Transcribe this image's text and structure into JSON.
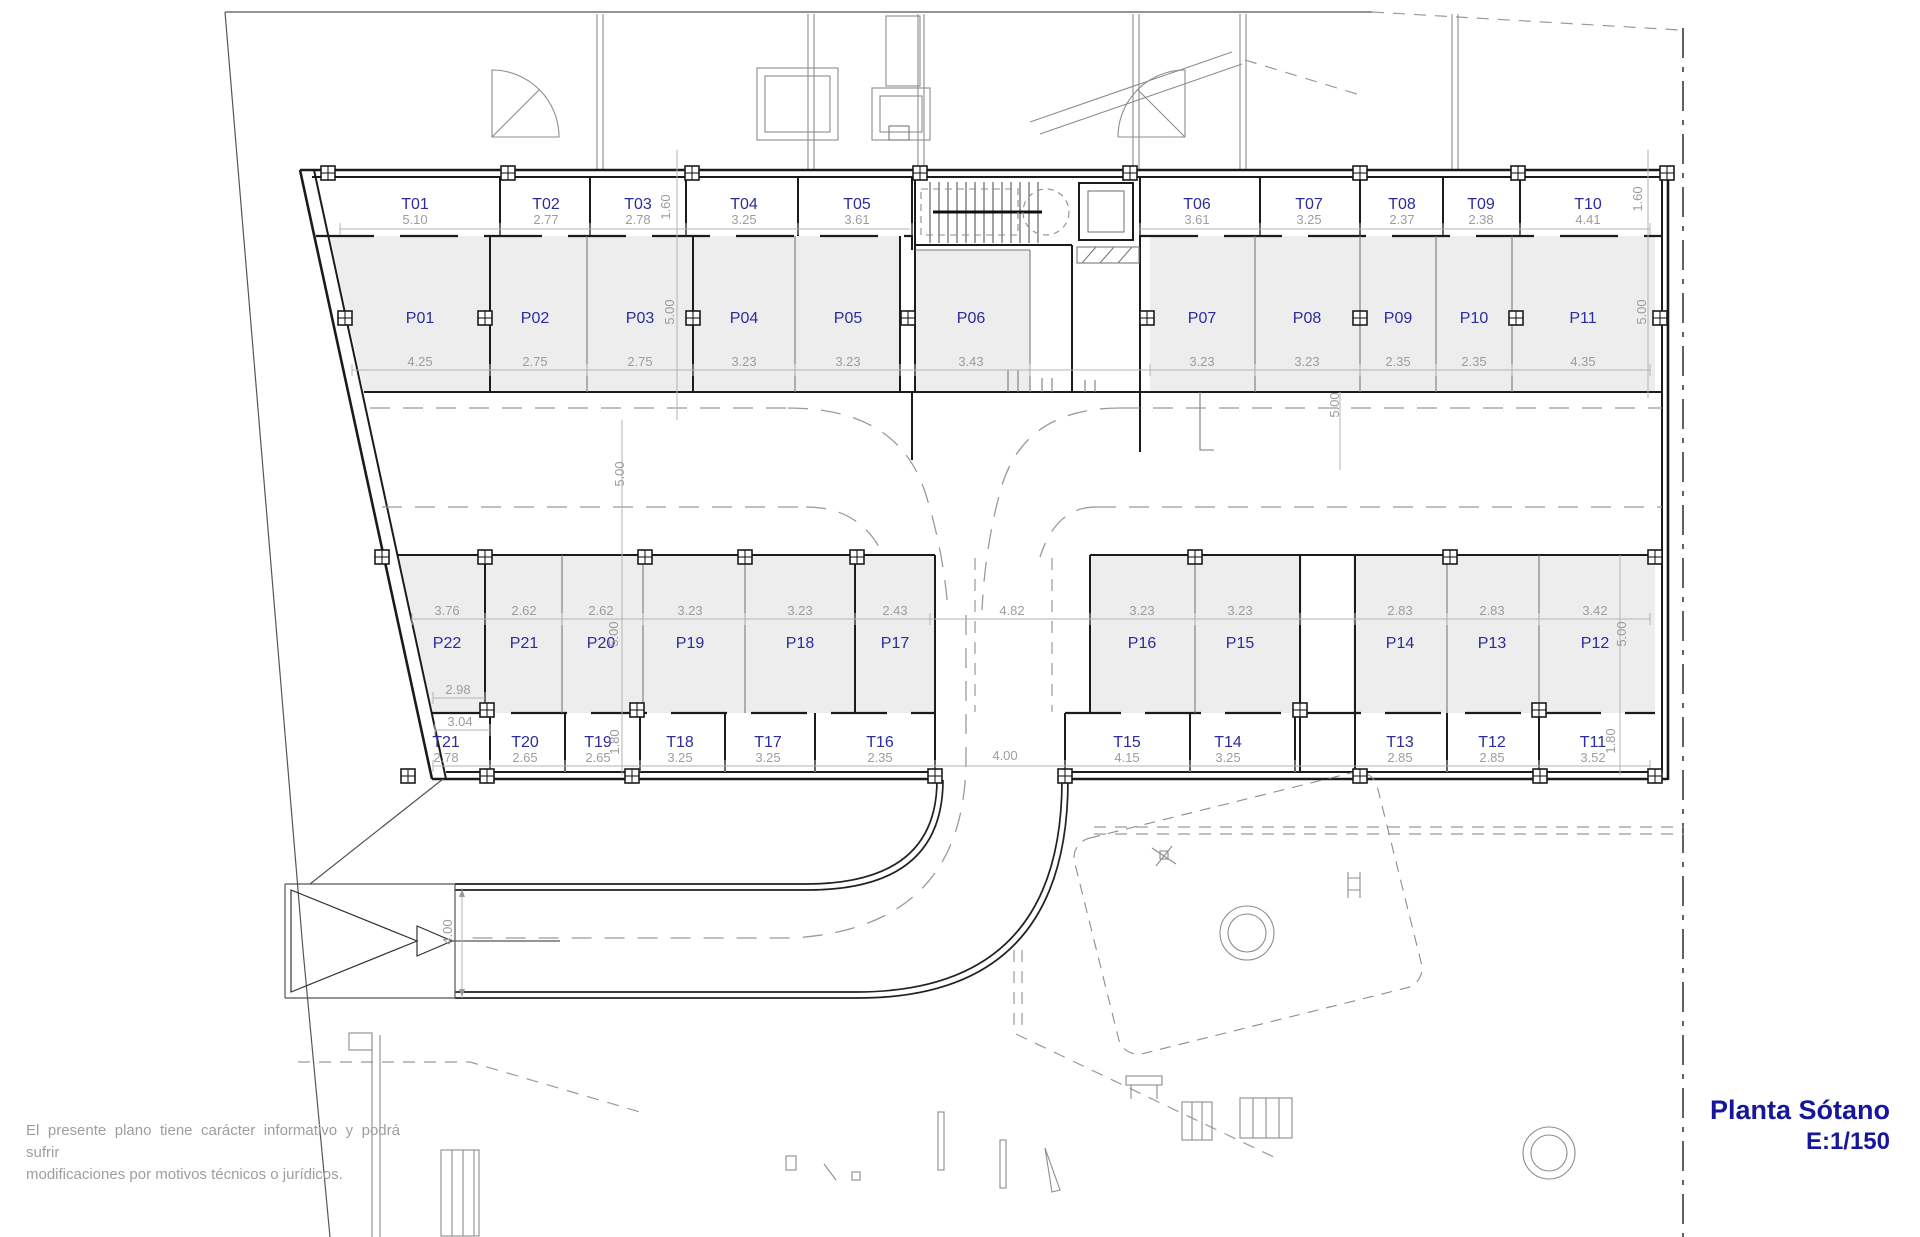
{
  "plan": {
    "title": "Planta Sótano",
    "scale": "E:1/150",
    "disclaimer_line1": "El presente plano tiene carácter informativo y podrá sufrir",
    "disclaimer_line2": "modificaciones por motivos técnicos o jurídicos.",
    "colors": {
      "label_blue": "#2b2b9e",
      "dim_gray": "#9d9d9d",
      "stall_fill": "#ededed",
      "wall": "#1b1b1b"
    },
    "storage_top": [
      {
        "id": "T01",
        "width": "5.10"
      },
      {
        "id": "T02",
        "width": "2.77"
      },
      {
        "id": "T03",
        "width": "2.78"
      },
      {
        "id": "T04",
        "width": "3.25"
      },
      {
        "id": "T05",
        "width": "3.61"
      },
      {
        "id": "T06",
        "width": "3.61"
      },
      {
        "id": "T07",
        "width": "3.25"
      },
      {
        "id": "T08",
        "width": "2.37"
      },
      {
        "id": "T09",
        "width": "2.38"
      },
      {
        "id": "T10",
        "width": "4.41"
      }
    ],
    "parking_top": [
      {
        "id": "P01",
        "width": "4.25"
      },
      {
        "id": "P02",
        "width": "2.75"
      },
      {
        "id": "P03",
        "width": "2.75"
      },
      {
        "id": "P04",
        "width": "3.23"
      },
      {
        "id": "P05",
        "width": "3.23"
      },
      {
        "id": "P06",
        "width": "3.43"
      },
      {
        "id": "P07",
        "width": "3.23"
      },
      {
        "id": "P08",
        "width": "3.23"
      },
      {
        "id": "P09",
        "width": "2.35"
      },
      {
        "id": "P10",
        "width": "2.35"
      },
      {
        "id": "P11",
        "width": "4.35"
      }
    ],
    "parking_bottom": [
      {
        "id": "P22",
        "width": "3.76"
      },
      {
        "id": "P21",
        "width": "2.62"
      },
      {
        "id": "P20",
        "width": "2.62"
      },
      {
        "id": "P19",
        "width": "3.23"
      },
      {
        "id": "P18",
        "width": "3.23"
      },
      {
        "id": "P17",
        "width": "2.43"
      },
      {
        "id": "P16",
        "width": "3.23"
      },
      {
        "id": "P15",
        "width": "3.23"
      },
      {
        "id": "P14",
        "width": "2.83"
      },
      {
        "id": "P13",
        "width": "2.83"
      },
      {
        "id": "P12",
        "width": "3.42"
      }
    ],
    "storage_bottom": [
      {
        "id": "T21",
        "width": "2.78"
      },
      {
        "id": "T20",
        "width": "2.65"
      },
      {
        "id": "T19",
        "width": "2.65"
      },
      {
        "id": "T18",
        "width": "3.25"
      },
      {
        "id": "T17",
        "width": "3.25"
      },
      {
        "id": "T16",
        "width": "2.35"
      },
      {
        "id": "T15",
        "width": "4.15"
      },
      {
        "id": "T14",
        "width": "3.25"
      },
      {
        "id": "T13",
        "width": "2.85"
      },
      {
        "id": "T12",
        "width": "2.85"
      },
      {
        "id": "T11",
        "width": "3.52"
      }
    ],
    "v_dims": {
      "storage_top_depth": "1.60",
      "parking_top_depth": "5.00",
      "driveway_width": "5.00",
      "parking_bottom_depth": "5.00",
      "storage_bottom_depth": "1.80"
    },
    "extra_dims": {
      "p22_extra": "2.98",
      "t21_extra": "3.04",
      "drive_gap": "4.82",
      "ramp_gap": "4.00",
      "ramp_width": "4.00"
    }
  }
}
